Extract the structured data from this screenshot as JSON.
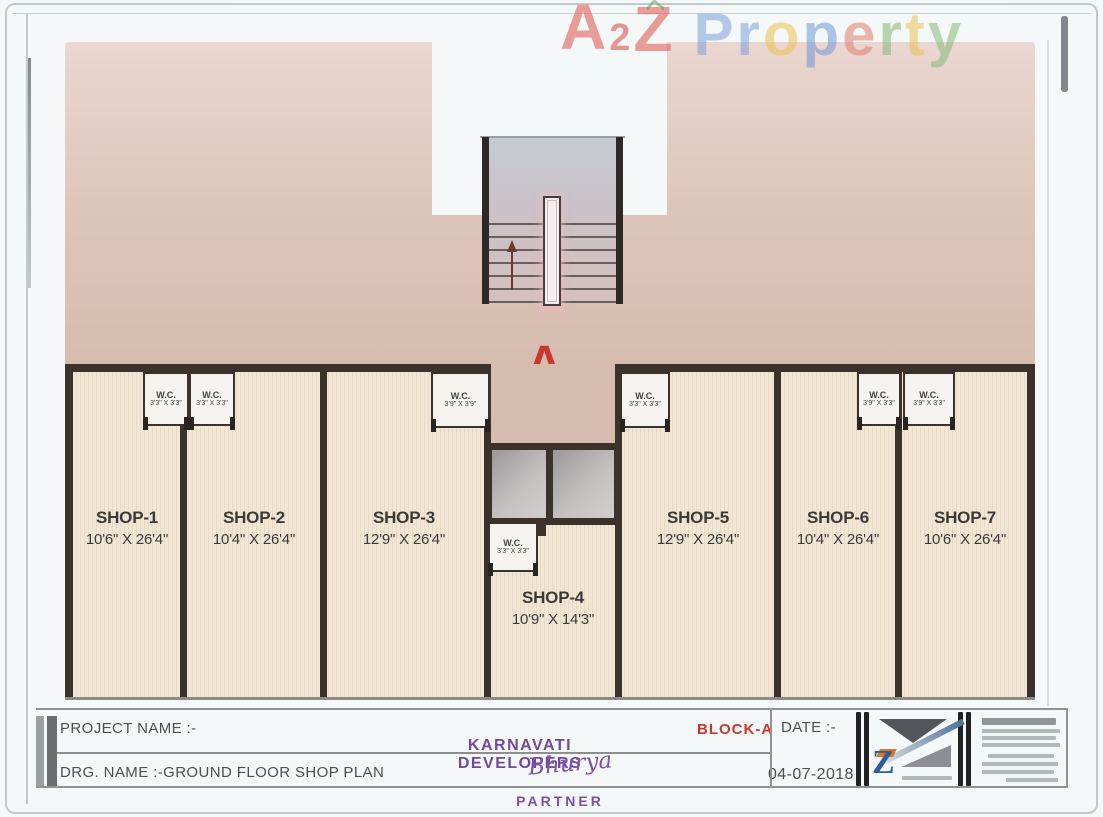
{
  "watermark": {
    "letters": [
      {
        "ch": "A",
        "color": "#e0504a",
        "size": 64,
        "dy": 0
      },
      {
        "ch": "2",
        "color": "#d4483f",
        "size": 38,
        "dy": 26
      },
      {
        "ch": "Z",
        "color": "#e0504a",
        "size": 64,
        "dy": 2
      },
      {
        "ch": "P",
        "color": "#7da2dc",
        "size": 60,
        "dy": 10
      },
      {
        "ch": "r",
        "color": "#7da2dc",
        "size": 60,
        "dy": 10
      },
      {
        "ch": "o",
        "color": "#eac24e",
        "size": 60,
        "dy": 10
      },
      {
        "ch": "p",
        "color": "#7098d6",
        "size": 60,
        "dy": 10
      },
      {
        "ch": "e",
        "color": "#e0806c",
        "size": 60,
        "dy": 10
      },
      {
        "ch": "r",
        "color": "#84ba74",
        "size": 60,
        "dy": 10
      },
      {
        "ch": "t",
        "color": "#eac24e",
        "size": 60,
        "dy": 10
      },
      {
        "ch": "y",
        "color": "#86bc78",
        "size": 60,
        "dy": 10
      }
    ]
  },
  "plan": {
    "block_label": "A",
    "shops": [
      {
        "name": "SHOP-1",
        "dim": "10'6\" X 26'4\""
      },
      {
        "name": "SHOP-2",
        "dim": "10'4\" X 26'4\""
      },
      {
        "name": "SHOP-3",
        "dim": "12'9\" X 26'4\""
      },
      {
        "name": "SHOP-4",
        "dim": "10'9\" X 14'3\""
      },
      {
        "name": "SHOP-5",
        "dim": "12'9\" X 26'4\""
      },
      {
        "name": "SHOP-6",
        "dim": "10'4\" X 26'4\""
      },
      {
        "name": "SHOP-7",
        "dim": "10'6\" X 26'4\""
      }
    ],
    "wcs": [
      {
        "label": "W.C.",
        "dim": "3'3\" X 3'3\"",
        "shop": "SHOP-1"
      },
      {
        "label": "W.C.",
        "dim": "3'3\" X 3'3\"",
        "shop": "SHOP-2"
      },
      {
        "label": "W.C.",
        "dim": "3'9\" X 3'9\"",
        "shop": "SHOP-3"
      },
      {
        "label": "W.C.",
        "dim": "3'3\" X 3'3\"",
        "shop": "SHOP-4"
      },
      {
        "label": "W.C.",
        "dim": "3'3\" X 3'3\"",
        "shop": "SHOP-5"
      },
      {
        "label": "W.C.",
        "dim": "3'9\" X 3'3\"",
        "shop": "SHOP-6"
      },
      {
        "label": "W.C.",
        "dim": "3'9\" X 3'3\"",
        "shop": "SHOP-7"
      }
    ]
  },
  "title_block": {
    "project_name_label": "PROJECT NAME :-",
    "drg_name_label": "DRG. NAME  :-GROUND FLOOR SHOP PLAN",
    "company_name": "KARNAVATI DEVELOPERS",
    "signature": "Bhurya",
    "partner_label": "PARTNER",
    "block_label": "BLOCK-A",
    "date_label": "DATE :-",
    "date_value": "04-07-2018",
    "logo_letter": "Z"
  },
  "colors": {
    "accent_red": "#c9382e",
    "purple": "#6f4a9e",
    "partner_purple": "#7b50a8",
    "wall": "#3b332b",
    "logo_blue": "#2e5e98",
    "logo_orange": "#e0761c"
  }
}
